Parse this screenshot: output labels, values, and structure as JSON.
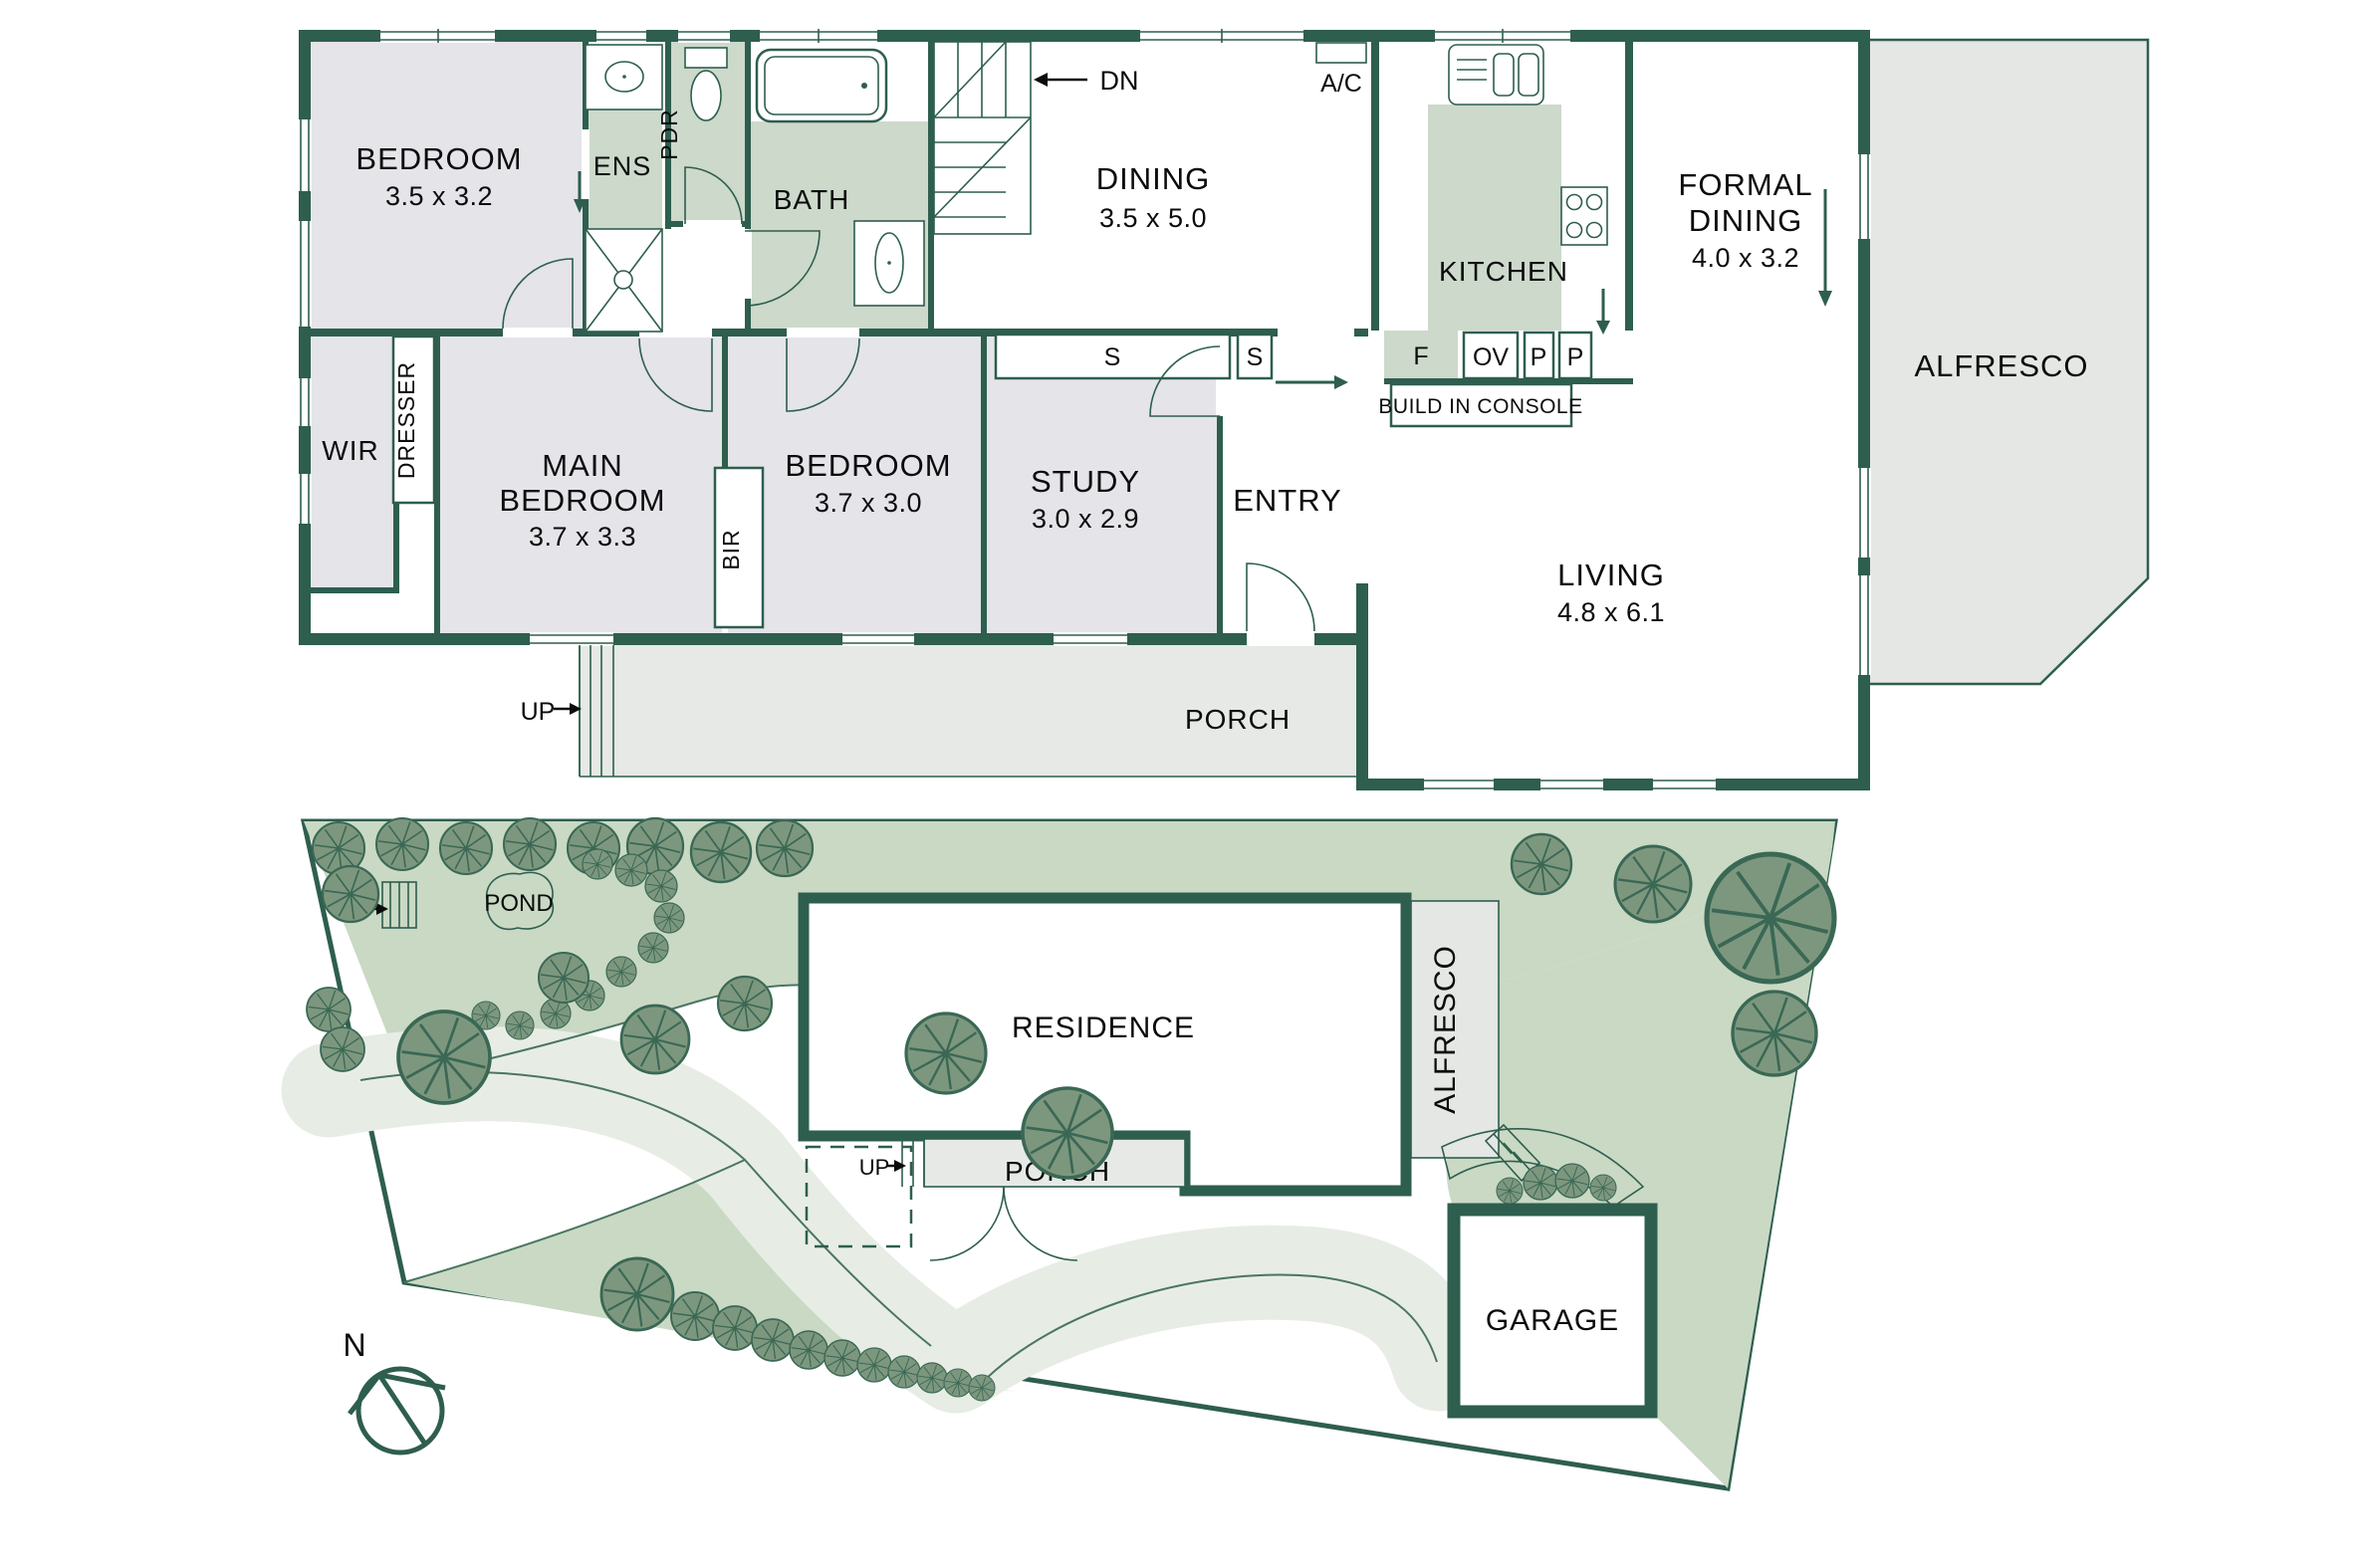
{
  "colors": {
    "wall": "#2e5e4e",
    "room_grey": "#e4e4e9",
    "sage": "#ccd9cb",
    "porch_grey": "#e6e9e5",
    "alfresco_grey": "#e4e7e3",
    "site_base": "#dfe8dc",
    "site_bed": "#c9d9c4",
    "site_drive": "#e7ede5",
    "tree_fill": "#7d977f",
    "tree_line": "#3a6854",
    "text": "#0b0b0b"
  },
  "floor_plan": {
    "bedroom1": {
      "name": "BEDROOM",
      "dims": "3.5 x 3.2"
    },
    "ens": {
      "name": "ENS"
    },
    "pdr": {
      "name": "PDR"
    },
    "bath": {
      "name": "BATH"
    },
    "stairs": {
      "dn": "DN"
    },
    "dining": {
      "name": "DINING",
      "dims": "3.5 x 5.0"
    },
    "ac": "A/C",
    "kitchen": {
      "name": "KITCHEN"
    },
    "formal_dining": {
      "line1": "FORMAL",
      "line2": "DINING",
      "dims": "4.0 x 3.2"
    },
    "alfresco": {
      "name": "ALFRESCO"
    },
    "wir": {
      "name": "WIR"
    },
    "dresser": "DRESSER",
    "main_bedroom": {
      "line1": "MAIN",
      "line2": "BEDROOM",
      "dims": "3.7 x 3.3"
    },
    "bir": "BIR",
    "bedroom2": {
      "name": "BEDROOM",
      "dims": "3.7 x 3.0"
    },
    "study": {
      "name": "STUDY",
      "dims": "3.0 x 2.9"
    },
    "entry": {
      "name": "ENTRY"
    },
    "living": {
      "name": "LIVING",
      "dims": "4.8 x 6.1"
    },
    "porch": {
      "name": "PORCH"
    },
    "up": "UP",
    "storage": "S",
    "fridge": "F",
    "oven": "OV",
    "pantry": "P",
    "console": "BUILD IN CONSOLE"
  },
  "site_plan": {
    "residence": "RESIDENCE",
    "alfresco": "ALFRESCO",
    "porch": "PORCH",
    "garage": "GARAGE",
    "pond": "POND",
    "up": "UP"
  },
  "compass": {
    "north": "N"
  }
}
